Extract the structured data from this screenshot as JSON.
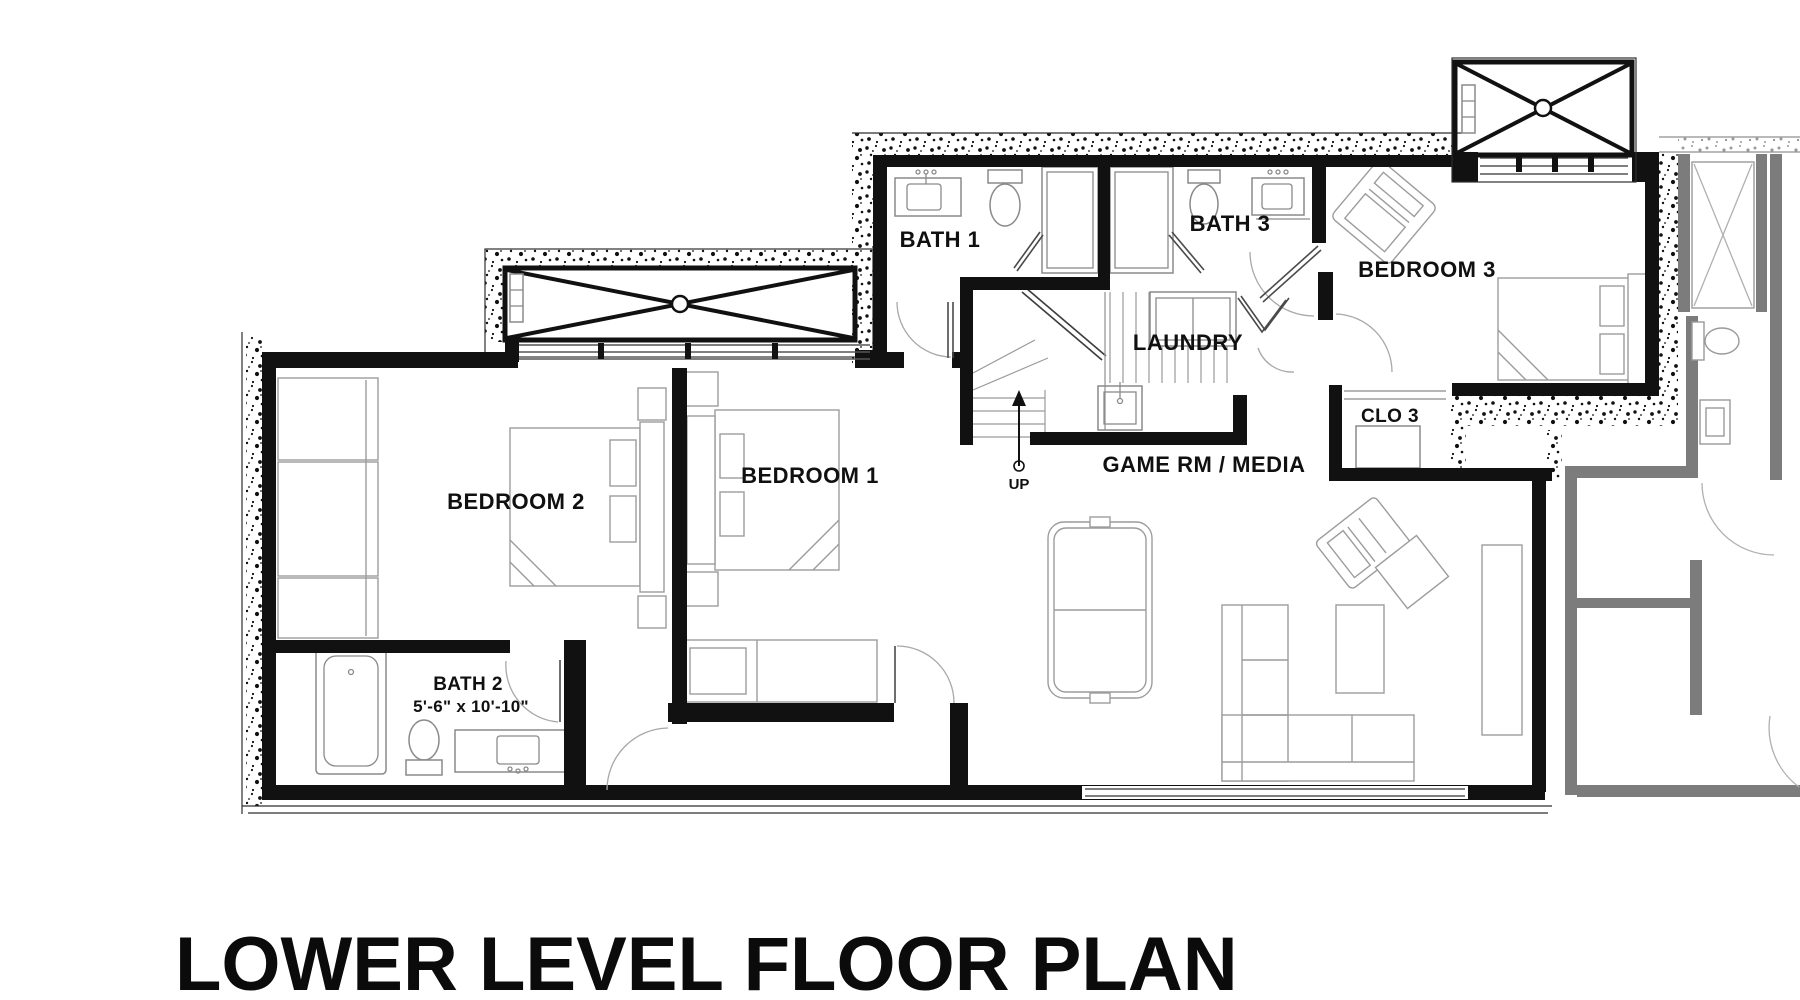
{
  "title": "LOWER LEVEL FLOOR PLAN",
  "rooms": {
    "bath1": {
      "label": "BATH 1"
    },
    "bath3": {
      "label": "BATH 3"
    },
    "bedroom3": {
      "label": "BEDROOM 3"
    },
    "laundry": {
      "label": "LAUNDRY"
    },
    "closet3": {
      "label": "CLO 3"
    },
    "bedroom2": {
      "label": "BEDROOM 2"
    },
    "bedroom1": {
      "label": "BEDROOM 1"
    },
    "bath2": {
      "label": "BATH 2",
      "dimensions": "5'-6\" x 10'-10\""
    },
    "game_room": {
      "label": "GAME RM / MEDIA"
    }
  },
  "stairs": {
    "direction_label": "UP"
  },
  "colors": {
    "wall": "#111111",
    "neighbor_wall": "#7c7c7c",
    "fixture_line": "#8a8a8a",
    "background": "#ffffff"
  }
}
